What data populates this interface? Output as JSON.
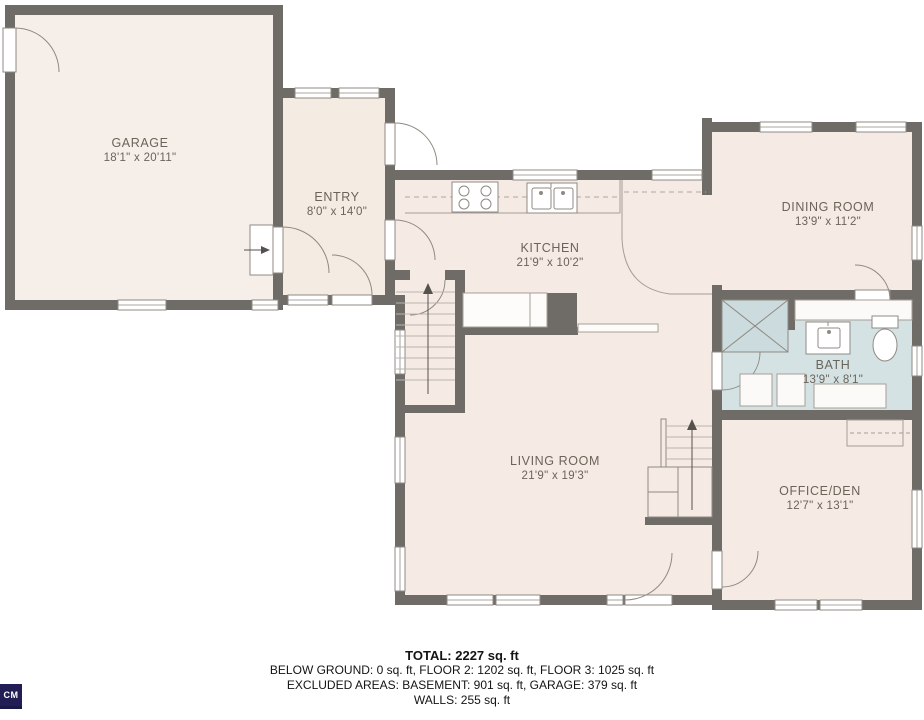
{
  "rooms": [
    {
      "name": "GARAGE",
      "dims": "18'1\" x 20'11\""
    },
    {
      "name": "ENTRY",
      "dims": "8'0\" x 14'0\""
    },
    {
      "name": "KITCHEN",
      "dims": "21'9\" x 10'2\""
    },
    {
      "name": "DINING ROOM",
      "dims": "13'9\" x 11'2\""
    },
    {
      "name": "BATH",
      "dims": "13'9\" x 8'1\""
    },
    {
      "name": "LIVING ROOM",
      "dims": "21'9\" x 19'3\""
    },
    {
      "name": "OFFICE/DEN",
      "dims": "12'7\" x 13'1\""
    }
  ],
  "footer": {
    "total": "TOTAL: 2227 sq. ft",
    "floors": "BELOW GROUND: 0 sq. ft, FLOOR 2: 1202 sq. ft, FLOOR 3: 1025 sq. ft",
    "excluded": "EXCLUDED AREAS: BASEMENT: 901 sq. ft, GARAGE: 379 sq. ft",
    "walls": "WALLS: 255 sq. ft"
  },
  "watermark": "CM",
  "colors": {
    "wall": "#6f6b67",
    "floor": "#f5ebe4",
    "bath_floor": "#d5e2e4",
    "fixture_line": "#8f8a83"
  }
}
